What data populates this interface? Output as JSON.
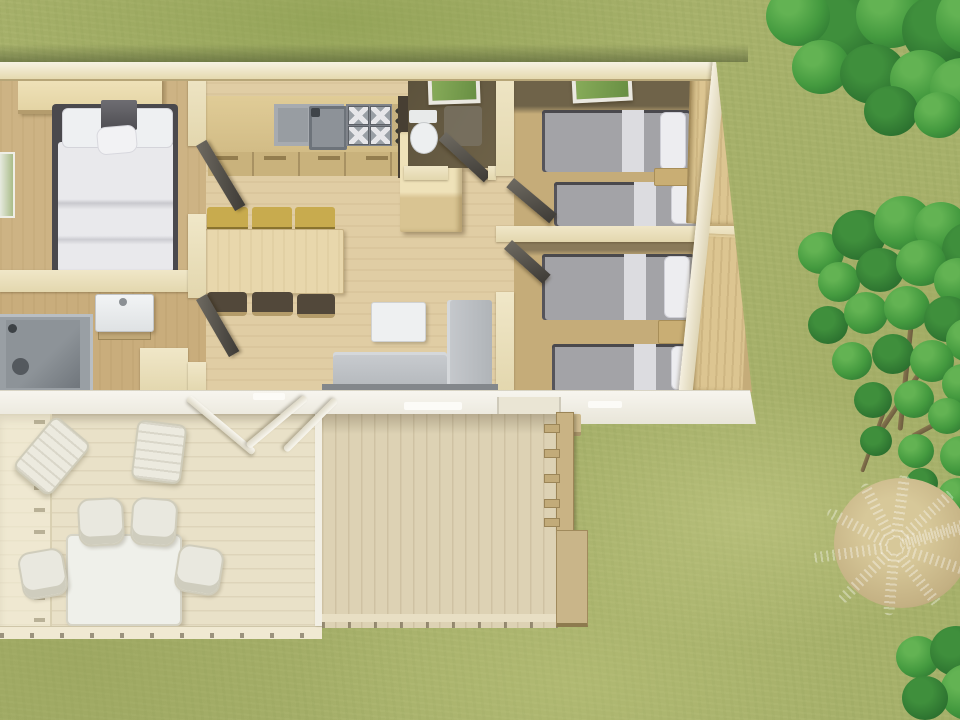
{
  "scene": {
    "description": "3D aerial rendering of a mobile-home floor plan with covered wooden terrace set on a grass lawn with trees",
    "ground": "grass lawn",
    "vegetation": [
      "tree-top-right",
      "tree-right",
      "dried-fern-clump",
      "bush-bottom-right"
    ]
  },
  "floor_plan": {
    "rooms": [
      {
        "name": "master-bedroom",
        "furniture": [
          "double-bed",
          "overhead-cabinet",
          "side-window"
        ]
      },
      {
        "name": "bathroom",
        "furniture": [
          "washbasin",
          "shower-cabin"
        ]
      },
      {
        "name": "kitchen-living-room",
        "furniture": [
          "kitchen-counter",
          "sink",
          "gas-hob",
          "base-cabinets",
          "tall-cabinet",
          "dining-table",
          "bench-seats-x3",
          "chairs-x3",
          "corner-sofa",
          "coffee-table"
        ]
      },
      {
        "name": "wc",
        "furniture": [
          "toilet",
          "skylight-window"
        ]
      },
      {
        "name": "bedroom-2",
        "furniture": [
          "twin-bed",
          "twin-bed",
          "nightstand",
          "wardrobe",
          "skylight-window"
        ]
      },
      {
        "name": "bedroom-3",
        "furniture": [
          "twin-bed",
          "twin-bed",
          "nightstand",
          "wardrobe"
        ]
      }
    ],
    "outdoor": [
      {
        "name": "covered-terrace",
        "furniture": [
          "garden-table",
          "garden-chairs-x4",
          "lounge-chairs-x2",
          "side-railing",
          "roof-braces"
        ]
      },
      {
        "name": "slatted-deck",
        "furniture": [
          "railing-with-rungs",
          "access-step"
        ]
      }
    ]
  },
  "palette": {
    "grass": "#a6b06a",
    "tree_green": "#449a3f",
    "dried_fern": "#c4b183",
    "wall_cream": "#ece2bf",
    "floor_wood": "#e0cda4",
    "bedroom_floor": "#c5ac79",
    "wardrobe_tan": "#dcc591",
    "bed_blanket_gray": "#a3a3a7",
    "bed_linen_white": "#ededf0",
    "counter_gray": "#a7abb0",
    "hob_dark": "#7f838a",
    "bench_yellow": "#c8ab4e",
    "sofa_gray": "#bcc0c4",
    "terrace_deck": "#e9e1c8",
    "slat_deck": "#ddd2b4",
    "white_trim": "#f3f1e9",
    "door_leaf_dark": "#4a463e",
    "skylight_glass": "#79a14c"
  }
}
